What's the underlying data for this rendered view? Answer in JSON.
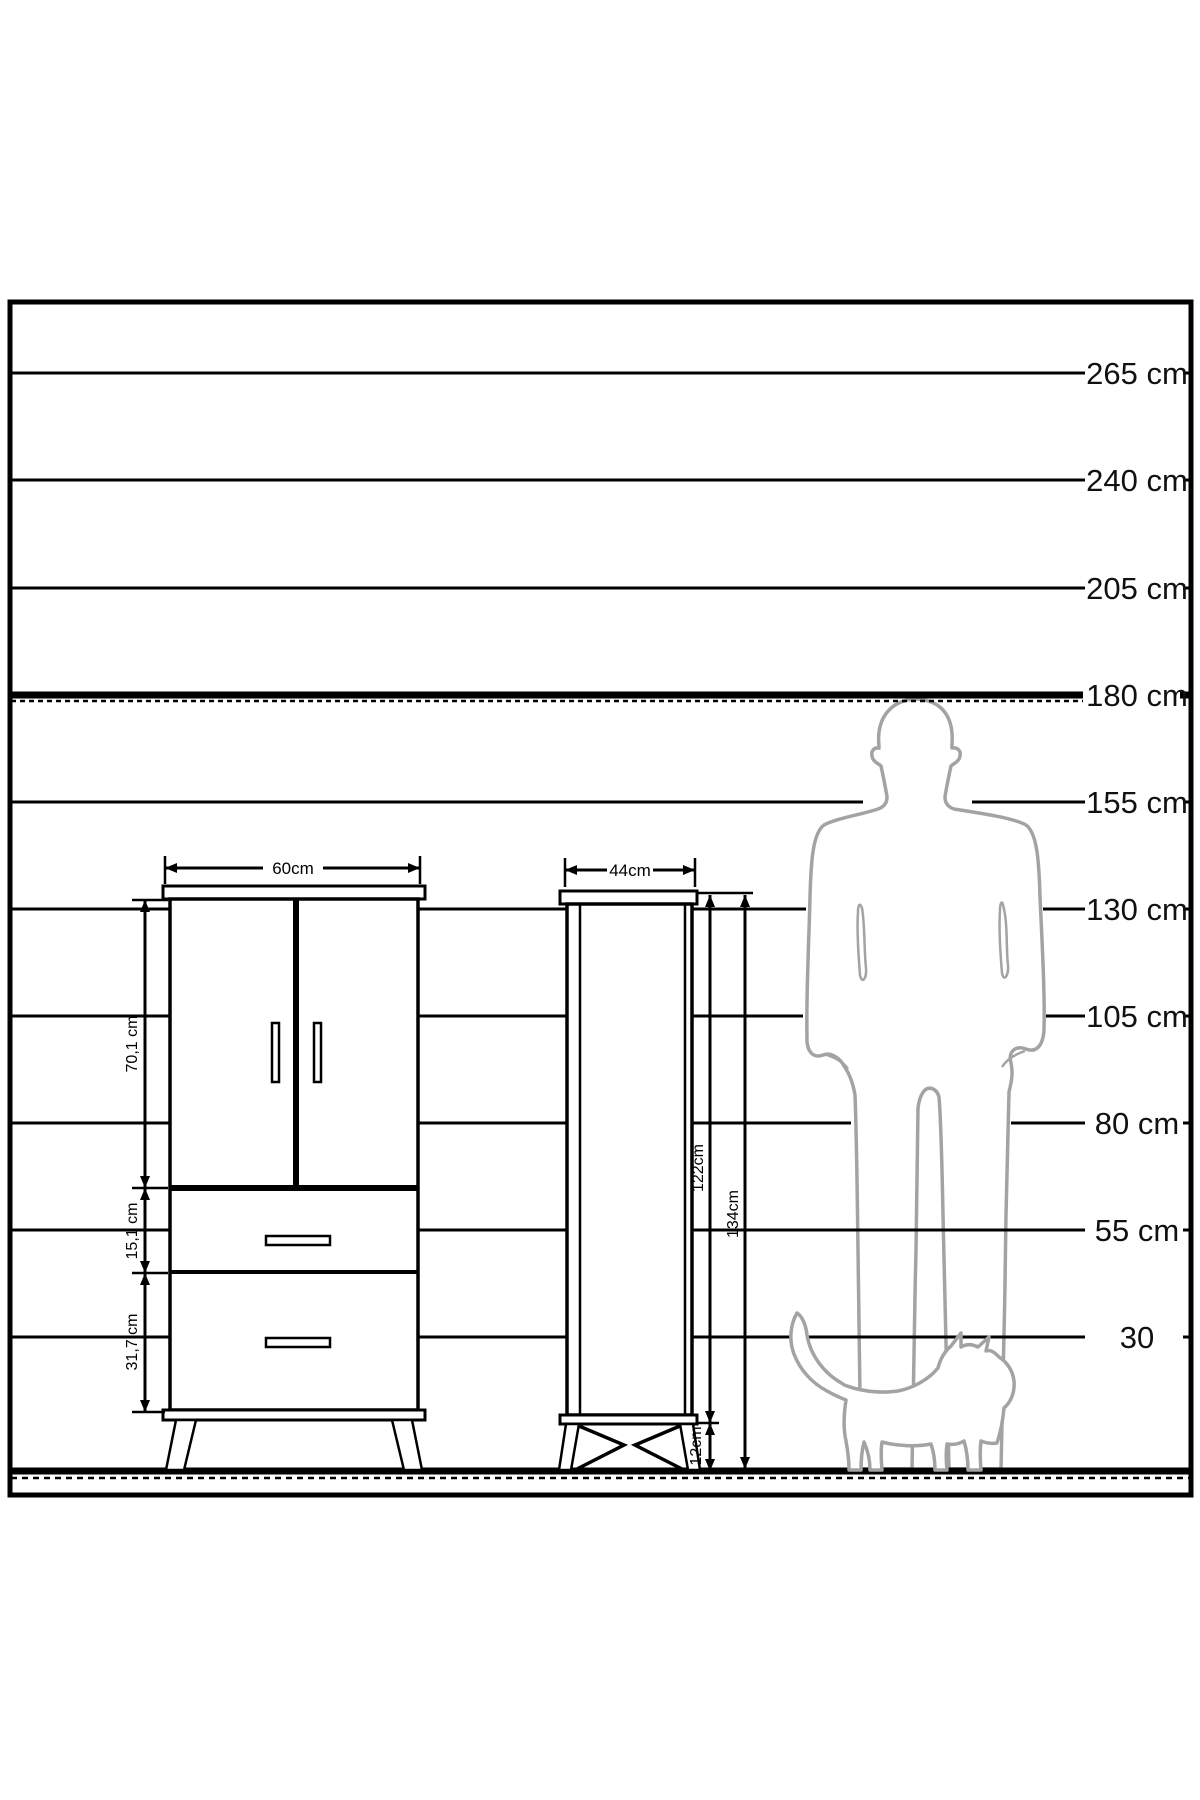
{
  "diagram": {
    "scale": {
      "labels": [
        "265 cm",
        "240 cm",
        "205 cm",
        "180 cm",
        "155 cm",
        "130 cm",
        "105 cm",
        "80 cm",
        "55 cm",
        "30"
      ]
    },
    "cabinet1": {
      "width_label": "60cm",
      "upper_section_height_label": "70,1 cm",
      "drawer_section_height_label": "15,1 cm",
      "lower_section_height_label": "31,7 cm"
    },
    "cabinet2": {
      "width_label": "44cm",
      "body_height_label": "122cm",
      "legs_height_label": "12cm",
      "total_height_label": "134cm"
    },
    "colors": {
      "line": "#000000",
      "silhouette_outline": "#a3a3a3",
      "background": "#ffffff"
    }
  }
}
